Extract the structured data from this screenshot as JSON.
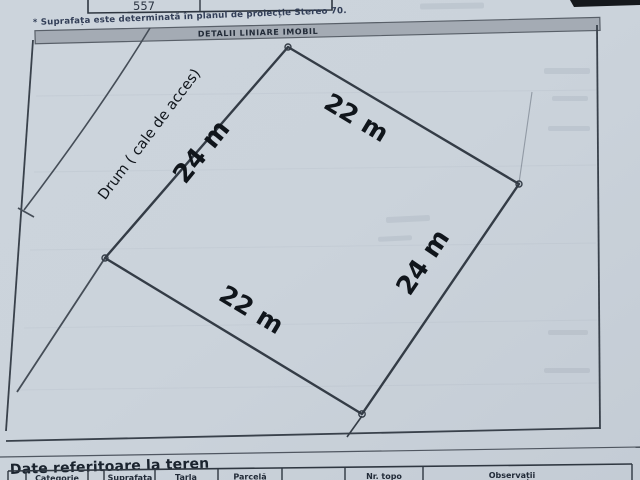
{
  "top": {
    "table_value": "557",
    "footnote": "* Suprafața este determinată în planul de proiecție Stereo 70."
  },
  "section_header": {
    "title": "DETALII LINIARE IMOBIL"
  },
  "plan": {
    "road_label": "Drum ( cale de acces)",
    "measurements": {
      "top_right": "22 m",
      "top_left": "24 m",
      "bottom_left": "22 m",
      "bottom_right": "24 m"
    }
  },
  "land_section": {
    "title": "Date referitoare la teren",
    "columns": [
      "Categorie",
      "Suprafata",
      "Tarla",
      "Parcelă",
      "Nr. topo",
      "Observații"
    ]
  },
  "colors": {
    "paper": "#cbd3db",
    "ink_line": "#343c46",
    "label_ink": "#10151b",
    "header_bar_fill": "#a4abb4",
    "small_print_ink": "#323e57"
  }
}
